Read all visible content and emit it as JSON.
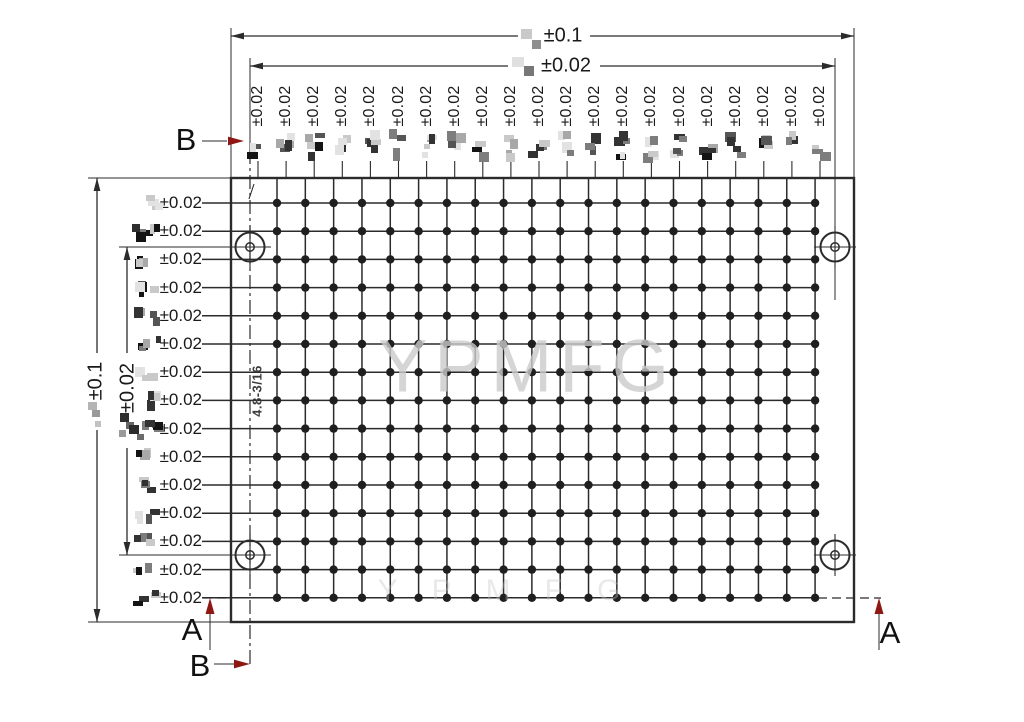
{
  "drawing": {
    "watermark": "YPMFG",
    "note": "4.8-3/16",
    "sections": {
      "a": "A",
      "b": "B"
    },
    "dims": {
      "top_overall": "±0.1",
      "top_hole_span": "±0.02",
      "left_overall": "±0.1",
      "left_hole_span": "±0.02",
      "column_pitch": "±0.02",
      "row_pitch": "±0.02"
    },
    "grid": {
      "columns": 20,
      "rows": 15,
      "column_pitch_label_count": 21,
      "row_pitch_label_count": 15
    },
    "colors": {
      "line": "#2b2b2b",
      "section_arrow": "#8e1713",
      "watermark": "#cccccc"
    }
  }
}
